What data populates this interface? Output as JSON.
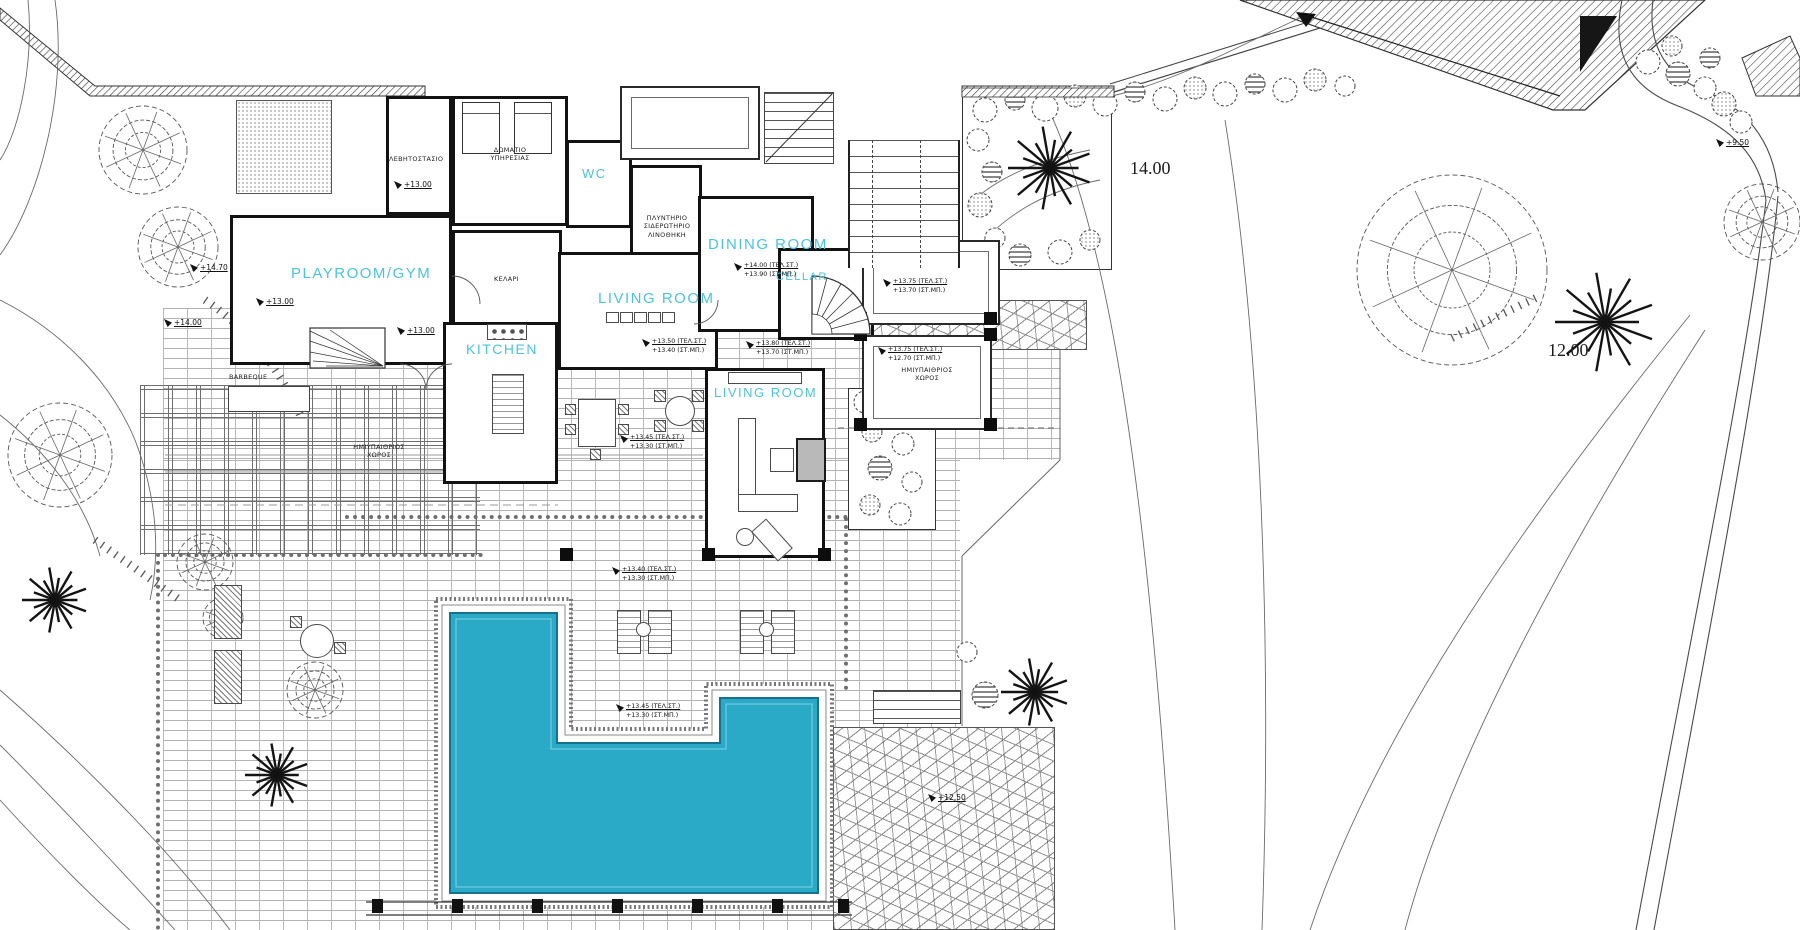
{
  "plan": {
    "title": "Villa ground-floor architectural site plan with swimming pool",
    "colors": {
      "pool_fill": "#2BAAC7",
      "pool_edge": "#17718D",
      "room_label": "#49C3DF",
      "ink": "#1d1d1d"
    },
    "rooms": [
      {
        "name": "playroom-gym",
        "label": "PLAYROOM/GYM"
      },
      {
        "name": "wc",
        "label": "WC"
      },
      {
        "name": "kitchen",
        "label": "KITCHEN"
      },
      {
        "name": "living-room-upper",
        "label": "LIVING ROOM"
      },
      {
        "name": "dining-room",
        "label": "DINING ROOM"
      },
      {
        "name": "cellar-stair",
        "label": "CELLAR"
      },
      {
        "name": "living-room-lower",
        "label": "LIVING ROOM"
      }
    ],
    "utility_labels": {
      "boiler_room": "ΛΕΒΗΤΟΣΤΑΣΙΟ",
      "service_room_line1": "ΔΩΜΑΤΙΟ",
      "service_room_line2": "ΥΠΗΡΕΣΙΑΣ",
      "laundry_line1": "ΠΛΥΝΤΗΡΙΟ",
      "laundry_line2": "ΣΙΔΕΡΩΤΗΡΙΟ",
      "laundry_line3": "ΛΙΝΟΘΗΚΗ",
      "cellar_room": "ΚΕΛΑΡΙ",
      "semi_open_line1": "ΗΜΙΥΠΑΙΘΡΙΟΣ",
      "semi_open_line2": "ΧΩΡΟΣ",
      "barbeque": "BARBEQUE"
    },
    "elevations": {
      "single": [
        {
          "text": "+14.70"
        },
        {
          "text": "+14.00"
        },
        {
          "text": "+13.00"
        },
        {
          "text": "+13.00"
        },
        {
          "text": "+13.00"
        },
        {
          "text": "+12.50"
        },
        {
          "text": "+9.50"
        }
      ],
      "pairs": [
        {
          "area": "dining",
          "l1": "+14.00  (ΤΕΛ.ΣΤ.)",
          "l2": "+13.90  (ΣΤ.ΜΠ.)"
        },
        {
          "area": "living-upper",
          "l1": "+13.50  (ΤΕΛ.ΣΤ.)",
          "l2": "+13.40  (ΣΤ.ΜΠ.)"
        },
        {
          "area": "hall",
          "l1": "+13.80  (ΤΕΛ.ΣΤ.)",
          "l2": "+13.70  (ΣΤ.ΜΠ.)"
        },
        {
          "area": "sitting-terrace",
          "l1": "+13.45  (ΤΕΛ.ΣΤ.)",
          "l2": "+13.30  (ΣΤ.ΜΠ.)"
        },
        {
          "area": "terrace-ne",
          "l1": "+13.75  (ΤΕΛ.ΣΤ.)",
          "l2": "+13.70  (ΣΤ.ΜΠ.)"
        },
        {
          "area": "semi-open-e",
          "l1": "+13.75  (ΤΕΛ.ΣΤ.)",
          "l2": "+12.70  (ΣΤ.ΜΠ.)"
        },
        {
          "area": "pool-deck-n",
          "l1": "+13.40  (ΤΕΛ.ΣΤ.)",
          "l2": "+13.30  (ΣΤ.ΜΠ.)"
        },
        {
          "area": "pool-deck-s",
          "l1": "+13.45  (ΤΕΛ.ΣΤ.)",
          "l2": "+13.30  (ΣΤ.ΜΠ.)"
        }
      ]
    },
    "contours": [
      {
        "text": "14.00"
      },
      {
        "text": "12.00"
      }
    ]
  }
}
